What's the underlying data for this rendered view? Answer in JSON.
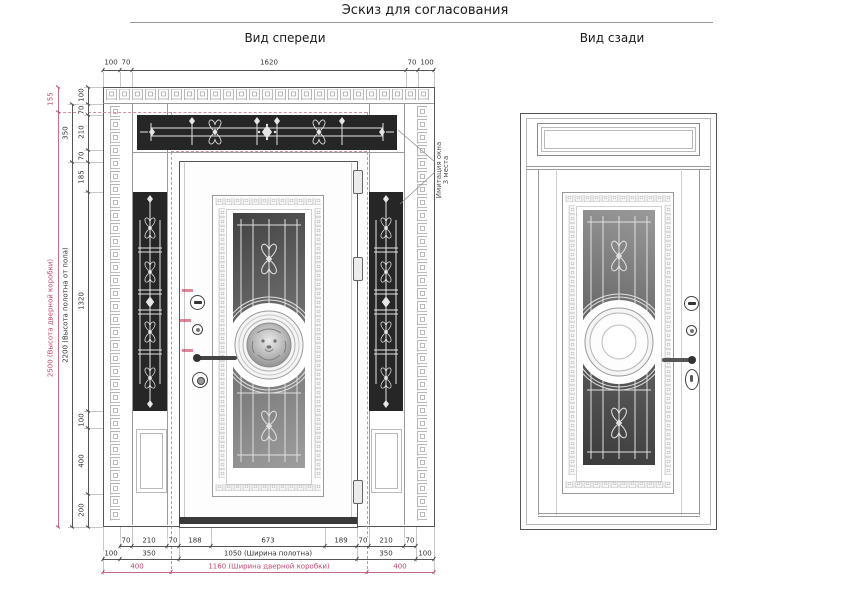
{
  "page": {
    "title": "Эскиз для согласования"
  },
  "front_view": {
    "title": "Вид спереди",
    "annotation": {
      "line1": "Имитация окна",
      "line2": "3 места"
    },
    "dims": {
      "top": [
        "100",
        "70",
        "1620",
        "70",
        "100"
      ],
      "left_inner": [
        "100",
        "70",
        "210",
        "70",
        "185",
        "1320",
        "100",
        "400",
        "200"
      ],
      "left_mid": [
        "350",
        "2200 (Высота полотна от пола)"
      ],
      "left_outer": [
        "155",
        "2500 (Высота дверной коробки)"
      ],
      "bottom_r1": [
        "70",
        "210",
        "70",
        "188",
        "673",
        "189",
        "70",
        "210",
        "70"
      ],
      "bottom_r2": [
        "100",
        "350",
        "1050 (Ширина полотна)",
        "350",
        "100"
      ],
      "bottom_r3": [
        "400",
        "1160 (Ширина дверной коробки)",
        "400"
      ]
    }
  },
  "back_view": {
    "title": "Вид сзади"
  },
  "icons": {
    "greek_key": "回"
  },
  "colors": {
    "accent_pink": "#c2476b",
    "dashed_pink": "#d08fa2",
    "glass_dark": "#262626",
    "grille_white": "#e6e6e6",
    "line_grey": "#555555"
  }
}
